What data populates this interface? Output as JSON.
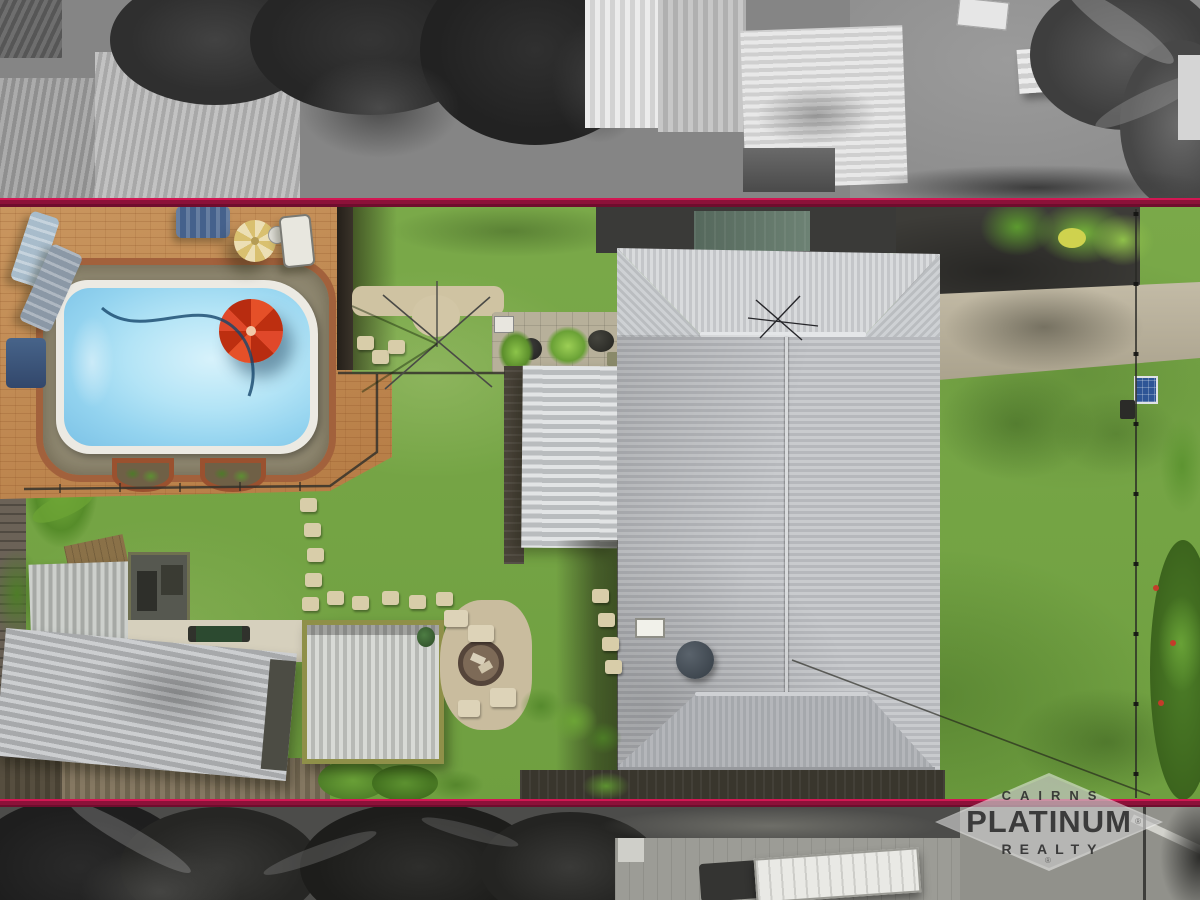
{
  "image": {
    "type": "aerial drone photograph of a residential property (real-estate listing)",
    "width_px": 1200,
    "height_px": 900,
    "effect": "subject lot shown in colour; neighbouring land desaturated to grayscale; lot boundary marked with two horizontal maroon lines"
  },
  "watermark": {
    "brand_line1": "CAIRNS",
    "brand_line2": "PLATINUM",
    "brand_line3": "REALTY",
    "registered_symbol": "®"
  },
  "boundary": {
    "line_color_bright": "#c2134e",
    "line_color_dark": "#7c0f34",
    "top_line_y_px": 198,
    "bottom_line_y_px": 799
  },
  "palette": {
    "lawn_green": "#79a948",
    "pool_water_blue": "#9fdcf3",
    "pool_coping_white": "#eceae3",
    "brick_paving_tan": "#c08a54",
    "pebble_surround": "#8e8770",
    "metal_roof_silver": "#c3c5c8",
    "red_pool_umbrella": "#d9431f",
    "patio_umbrella_cream": "#e4d8a9",
    "driveway_concrete": "#b8b09b",
    "shade_cloth_black": "#3a3a38",
    "solar_panel_blue": "#2e5596",
    "shed_trim_olive": "#8f9049",
    "grayscale_surround_gray": "#7f7f7f"
  },
  "scene_objects": [
    "swimming pool with red floating umbrella",
    "brick paved pool patio with loungers and cream umbrella",
    "rotary clothesline",
    "potted garden bed",
    "pergola awning",
    "main house corrugated metal hip roof with antenna and satellite dish",
    "two metal sheds and workshop shed with olive trim",
    "fire pit with block seats and gravel pad",
    "stepping stones across lawn",
    "rear boardwalk",
    "concrete driveway",
    "side fence with small solar panel",
    "neighbouring houses, palms and utility truck (desaturated)"
  ]
}
